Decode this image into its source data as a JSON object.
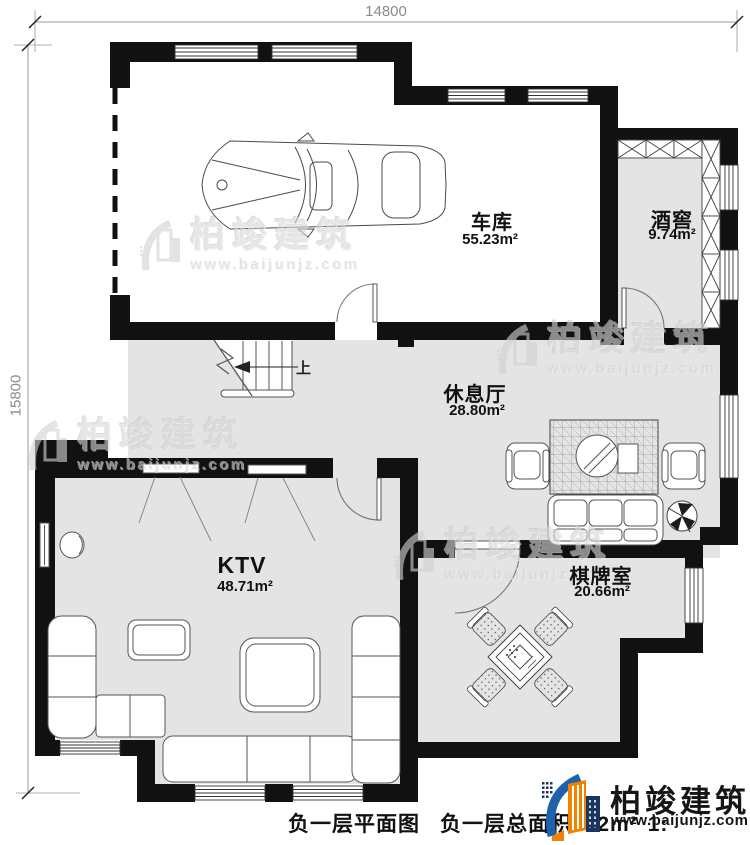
{
  "dimensions": {
    "top": "14800",
    "left": "15800"
  },
  "rooms": [
    {
      "name": "车库",
      "area": "55.23m²"
    },
    {
      "name": "酒窖",
      "area": "9.74m²"
    },
    {
      "name": "休息厅",
      "area": "28.80m²"
    },
    {
      "name": "KTV",
      "area": "48.71m²"
    },
    {
      "name": "棋牌室",
      "area": "20.66m²"
    }
  ],
  "stairs": {
    "up_label": "上"
  },
  "caption": {
    "title": "负一层平面图",
    "area_note": "负一层总面积202m²",
    "scale_fragment": "1:"
  },
  "watermark": {
    "brand": "柏竣建筑",
    "url": "www.baijunjz.com"
  },
  "logo": {
    "brand": "柏竣建筑",
    "url": "www.baijunjz.com"
  },
  "colors": {
    "wall": "#111111",
    "floor": "#e4e4e4",
    "watermark": "#d8d8d8",
    "logo_blue": "#1e62ad",
    "logo_orange": "#f08300",
    "logo_navy": "#17355e"
  }
}
